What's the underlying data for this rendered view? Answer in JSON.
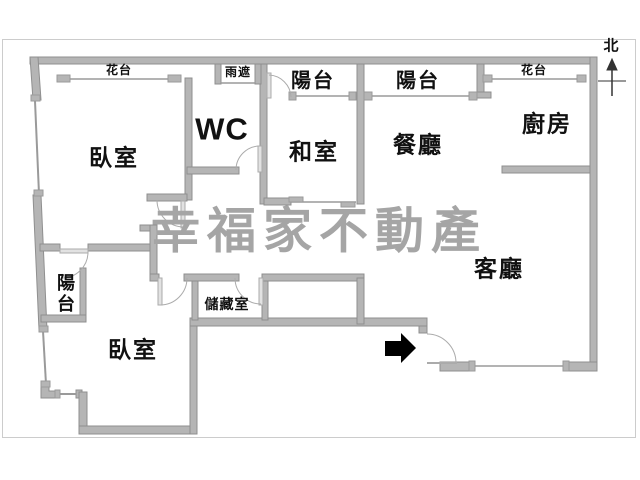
{
  "watermark": {
    "text": "幸福家不動產"
  },
  "compass": {
    "label": "北"
  },
  "rooms": {
    "bedroom_top": "臥室",
    "wc": "WC",
    "tatami": "和室",
    "dining": "餐廳",
    "kitchen": "廚房",
    "living": "客廳",
    "bedroom_bottom": "臥室",
    "storage": "儲藏室",
    "balcony_top_center": "陽台",
    "balcony_top_right": "陽台",
    "balcony_left": "陽台"
  },
  "annotations": {
    "flower_stand_left": "花台",
    "rain_cover": "雨遮",
    "flower_stand_right": "花台"
  },
  "colors": {
    "wall": "#b5b5b5",
    "wall_edge": "#8f8f8f",
    "window_line": "#9a9a9a",
    "text": "#111111",
    "watermark": "#a5a5a5",
    "entrance_arrow": "#000000",
    "canvas_border": "#cccccc"
  }
}
